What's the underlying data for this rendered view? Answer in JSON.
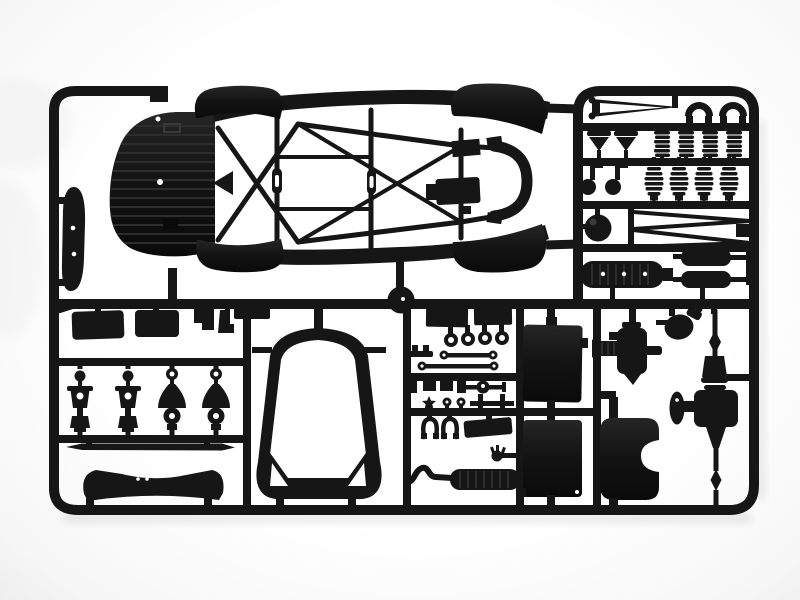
{
  "scene": {
    "caption": "Black injection-molded model kit sprue on white background",
    "kind": "product-photo"
  },
  "colors": {
    "background": "#ffffff",
    "plastic": "#161616",
    "plastic_dark": "#0a0a0a",
    "rib": "#2d2d2d",
    "hole": "#ffffff"
  },
  "parts": {
    "frame": {
      "label": "sprue runner frame"
    },
    "gate_disc": {
      "label": "round sprue gate disc"
    },
    "chassis": {
      "label": "space-frame roll-cage chassis (top view)"
    },
    "hood": {
      "label": "front hood and splitter panel with ribs"
    },
    "fenders": {
      "label": "four fender flares"
    },
    "side_skirt": {
      "label": "side skirt blade panel"
    },
    "silencers": {
      "label": "two exhaust silencer boxes"
    },
    "shocks": {
      "label": "two front shock absorber units"
    },
    "uprights": {
      "label": "two suspension uprights"
    },
    "anti_roll_bar": {
      "label": "anti-roll bar rod"
    },
    "dashboard": {
      "label": "curved dashboard cowl"
    },
    "windscreen": {
      "label": "windscreen frame ring with corner gussets"
    },
    "bushings": {
      "label": "four bushing rings"
    },
    "tie_rods": {
      "label": "two tie rods with eye ends"
    },
    "linkages": {
      "label": "small linkage blocks and clips"
    },
    "exhaust": {
      "label": "exhaust pipe with ribbed muffler"
    },
    "radiators": {
      "label": "two radiator cores"
    },
    "oil_tank": {
      "label": "oil tank with side notch"
    },
    "differential": {
      "label": "differential housing with stub axles"
    },
    "driveshaft": {
      "label": "drive axle with CV joints and wheel flange"
    },
    "springs": {
      "label": "four coil springs"
    },
    "bellows": {
      "label": "four suspension bellows boots"
    },
    "mufflers": {
      "label": "ribbed muffler and twin silencer cans"
    },
    "wishbones": {
      "label": "thin wishbone control arms"
    },
    "arches": {
      "label": "two arch brackets"
    },
    "reservoir": {
      "label": "round reservoir flask"
    }
  }
}
